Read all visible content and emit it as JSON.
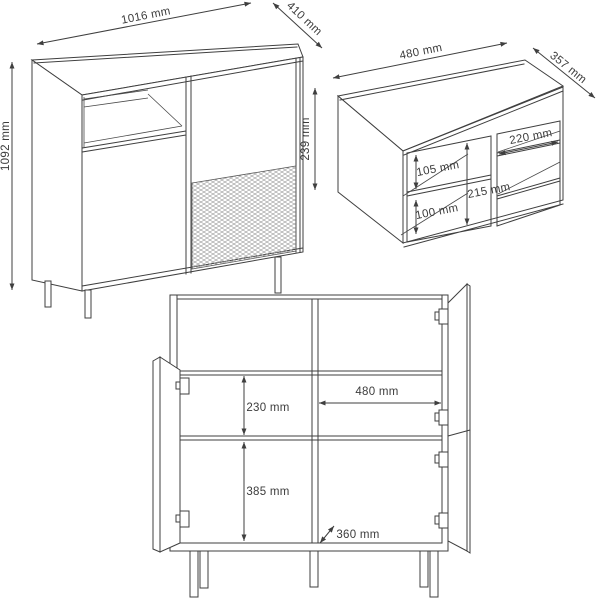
{
  "diagram": {
    "type": "furniture-technical-dimension-drawing",
    "background": "#ffffff",
    "line_color": "#3f3f3f",
    "mesh_color": "#9b9b9b",
    "unit": "mm"
  },
  "views": {
    "sideboard": {
      "name": "sideboard perspective view",
      "width": "1016 mm",
      "depth": "410 mm",
      "height": "1092 mm"
    },
    "insert": {
      "name": "shelf insert perspective view",
      "width": "480 mm",
      "depth": "357 mm",
      "height": "239 mm",
      "right_cubby_width": "220 mm",
      "upper_cubby_height": "105 mm",
      "lower_cubby_height": "100 mm",
      "interior_height": "215 mm"
    },
    "front": {
      "name": "sideboard front view with open doors",
      "upper_interior_height": "230 mm",
      "lower_interior_height": "385 mm",
      "right_interior_width": "480 mm",
      "interior_depth": "360 mm"
    }
  }
}
